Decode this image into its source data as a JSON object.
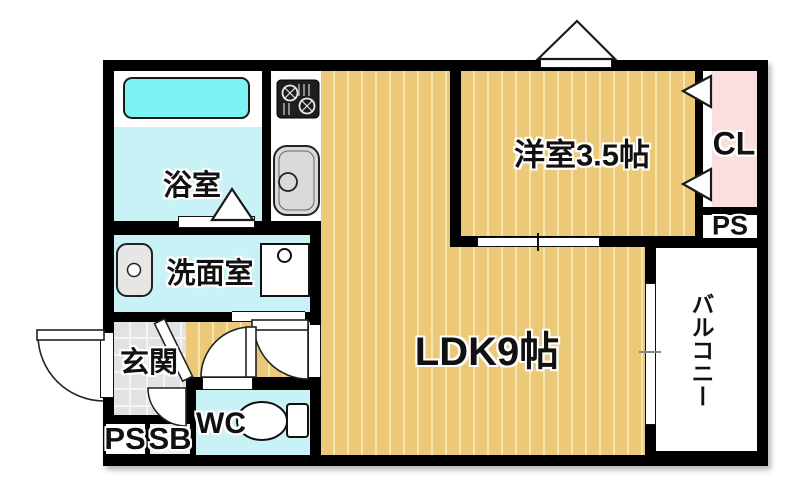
{
  "title": "apartment-floorplan",
  "rooms": {
    "bath": {
      "label": "浴室"
    },
    "washroom": {
      "label": "洗面室"
    },
    "entrance": {
      "label": "玄関"
    },
    "toilet": {
      "label": "WC"
    },
    "ldk": {
      "label": "LDK9帖"
    },
    "western_room": {
      "label": "洋室3.5帖"
    },
    "closet": {
      "label": "CL"
    },
    "balcony": {
      "label": "バルコニー"
    }
  },
  "labels": {
    "pipe_space_upper": "PS",
    "pipe_space_lower": "PS",
    "shoe_box": "SB"
  },
  "fixtures": [
    "bathtub",
    "gas-stove",
    "kitchen-sink",
    "washbasin",
    "washing-machine-pan",
    "toilet",
    "entrance-door-swing",
    "interior-door-swing",
    "wc-door-swing",
    "folding-closet-door",
    "window-marker",
    "sliding-door",
    "sliding-window"
  ],
  "colors": {
    "wall": "#000000",
    "floor_tan": "#ecc979",
    "floor_tan_stripe": "#f6e6ae",
    "wet_area_cyan": "#c9f2f6",
    "bathtub_cyan": "#7df2f5",
    "closet_pink": "#fbdede",
    "shoe_box_pink": "#f8eae6",
    "entrance_tile_gray": "#e2e2e2"
  }
}
